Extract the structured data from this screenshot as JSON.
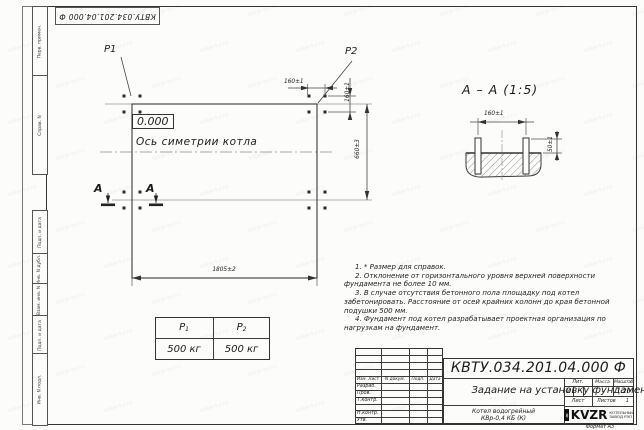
{
  "doc_number": "КВТУ.034.201.04.000 Ф",
  "margin_labels": [
    "Перв. примен.",
    "Справ. N",
    "Подп. и дата",
    "Инв. N дубл.",
    "Взам. инв. N",
    "Подп. и дата",
    "Инв. N подл."
  ],
  "plan": {
    "p1_label": "P1",
    "p2_label": "P2",
    "level_mark": "0.000",
    "axis_label": "Ось симетрии котла",
    "dim_length": "1805±2",
    "dim_width": "660±3",
    "dim_bolt_x": "160±1",
    "dim_bolt_y": "160±1",
    "section_letter": "А"
  },
  "section": {
    "title": "А – А (1:5)",
    "dim_bolt_spacing": "160±1",
    "dim_bolt_height": "50±1"
  },
  "load_table": {
    "col1_label": "P",
    "col1_sub": "1",
    "col2_label": "P",
    "col2_sub": "2",
    "col1_value": "500 кг",
    "col2_value": "500 кг"
  },
  "notes": [
    "1. * Размер для справок.",
    "2. Отклонение от горизонтального уровня верхней поверхности фундамента не более 10 мм.",
    "3. В случае отсутствия бетонного пола площадку под котел забетонировать. Расстояние от осей крайних колонн до края бетонной подушки 500 мм.",
    "4. Фундамент под котел разрабатывает проектная организация по нагрузкам на фундамент."
  ],
  "title_block": {
    "title": "Задание на установку фундамента",
    "product_line1": "Котел водогрейный",
    "product_line2": "КВр-0,4  КБ  (К)",
    "cols": [
      "Изм. Лист",
      "N докум.",
      "Подп.",
      "Дата"
    ],
    "rows": [
      "Разраб.",
      "Пров.",
      "Т.контр.",
      "Н.контр.",
      "Утв."
    ],
    "lit_label": "Лит.",
    "lit_value": "И",
    "mass_label": "Масса",
    "mass_value": "-",
    "scale_label": "Масштаб",
    "scale_value": "1:20",
    "sheet_label": "Лист",
    "sheets_label": "Листов",
    "sheets_value": "1",
    "logo_text": "KVZR",
    "logo_line1": "КОТЕЛЬНЫЙ",
    "logo_line2": "ЗАВОД РЭП",
    "format_label": "Формат А3"
  },
  "watermark": "kotel-kv.ru"
}
